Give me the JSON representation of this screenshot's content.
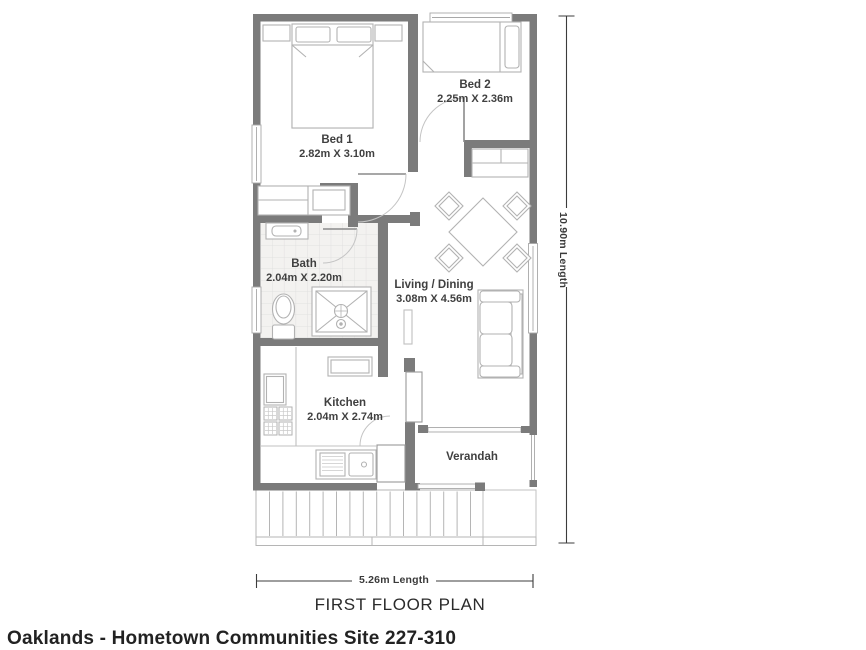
{
  "footer_title": "Oaklands - Hometown Communities Site 227-310",
  "plan_title": "FIRST FLOOR PLAN",
  "dimensions": {
    "height_label": "10.90m Length",
    "width_label": "5.26m Length"
  },
  "rooms": [
    {
      "name": "Bed 1",
      "dims": "2.82m X 3.10m"
    },
    {
      "name": "Bed 2",
      "dims": "2.25m X 2.36m"
    },
    {
      "name": "Bath",
      "dims": "2.04m X 2.20m"
    },
    {
      "name": "Living / Dining",
      "dims": "3.08m X 4.56m"
    },
    {
      "name": "Kitchen",
      "dims": "2.04m X 2.74m"
    },
    {
      "name": "Verandah",
      "dims": ""
    }
  ],
  "colors": {
    "wall": "#7b7b7b",
    "furniture_line": "#b2b2b2",
    "dimension_line": "#3c3c3c",
    "label_text": "#404040",
    "tile_line": "#dddddd"
  }
}
